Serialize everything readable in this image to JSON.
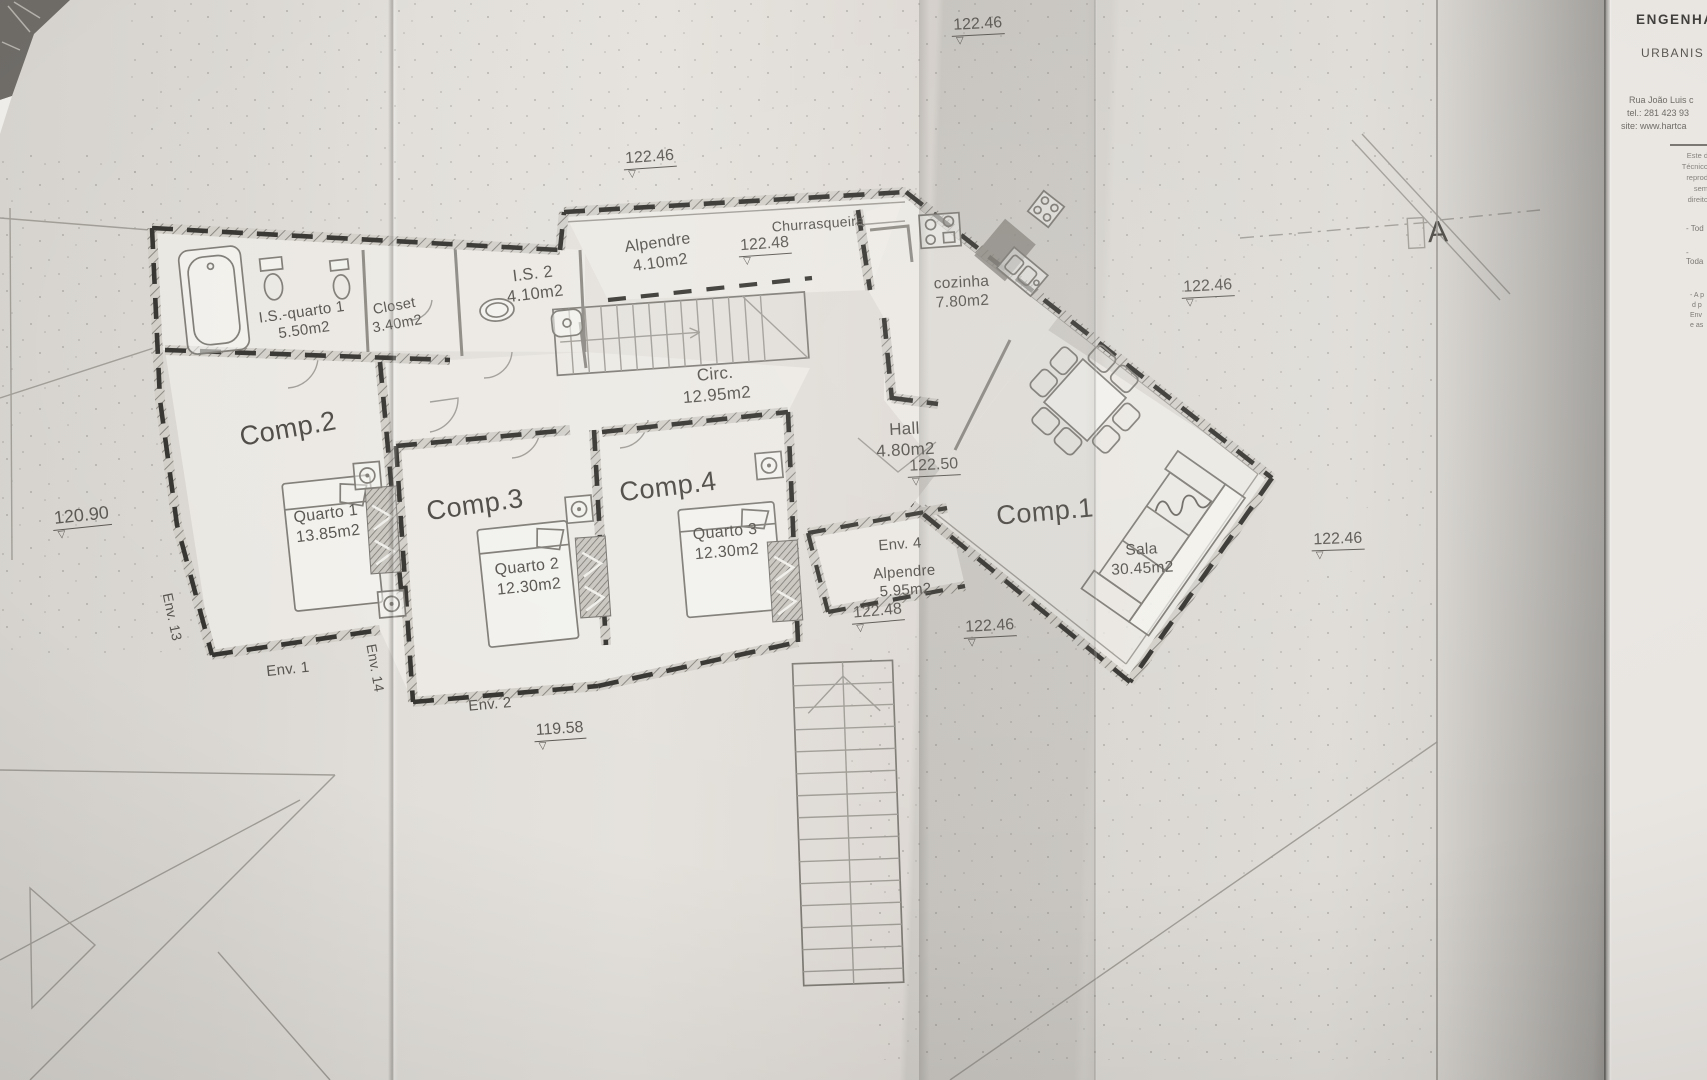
{
  "title_block": {
    "line1": "ENGENHA",
    "line2": "URBANIS",
    "address": "Rua João Luis c",
    "phone": "tel.: 281 423 93",
    "website": "site: www.hartca",
    "fine_print": [
      "Este d",
      "Técnico",
      "reprod",
      "sem",
      "direito"
    ],
    "notes": [
      "- Tod",
      "- Toda",
      "- A p",
      "d p",
      "Env",
      "e as"
    ]
  },
  "section_marker": {
    "label": "A"
  },
  "rooms": {
    "comp1": {
      "name": "Comp.1"
    },
    "comp2": {
      "name": "Comp.2"
    },
    "comp3": {
      "name": "Comp.3"
    },
    "comp4": {
      "name": "Comp.4"
    },
    "is_quarto1": {
      "name": "I.S.-quarto 1",
      "area": "5.50m2"
    },
    "closet": {
      "name": "Closet",
      "area": "3.40m2"
    },
    "is2": {
      "name": "I.S. 2",
      "area": "4.10m2"
    },
    "alpendre_norte": {
      "name": "Alpendre",
      "area": "4.10m2"
    },
    "churrasqueira": {
      "name": "Churrasqueira"
    },
    "cozinha": {
      "name": "cozinha",
      "area": "7.80m2"
    },
    "circ": {
      "name": "Circ.",
      "area": "12.95m2"
    },
    "hall": {
      "name": "Hall",
      "area": "4.80m2"
    },
    "quarto1": {
      "name": "Quarto 1",
      "area": "13.85m2"
    },
    "quarto2": {
      "name": "Quarto 2",
      "area": "12.30m2"
    },
    "quarto3": {
      "name": "Quarto 3",
      "area": "12.30m2"
    },
    "env4": {
      "name": "Env. 4"
    },
    "alpendre_sul": {
      "name": "Alpendre",
      "area": "5.95m2"
    },
    "sala": {
      "name": "Sala",
      "area": "30.45m2"
    }
  },
  "window_labels": {
    "env13": "Env. 13",
    "env1": "Env. 1",
    "env14": "Env. 14",
    "env2": "Env. 2"
  },
  "elevations": [
    {
      "value": "122.46"
    },
    {
      "value": "122.46"
    },
    {
      "value": "122.48"
    },
    {
      "value": "122.46"
    },
    {
      "value": "122.50"
    },
    {
      "value": "122.48"
    },
    {
      "value": "122.46"
    },
    {
      "value": "122.46"
    },
    {
      "value": "120.90"
    },
    {
      "value": "119.58"
    }
  ]
}
